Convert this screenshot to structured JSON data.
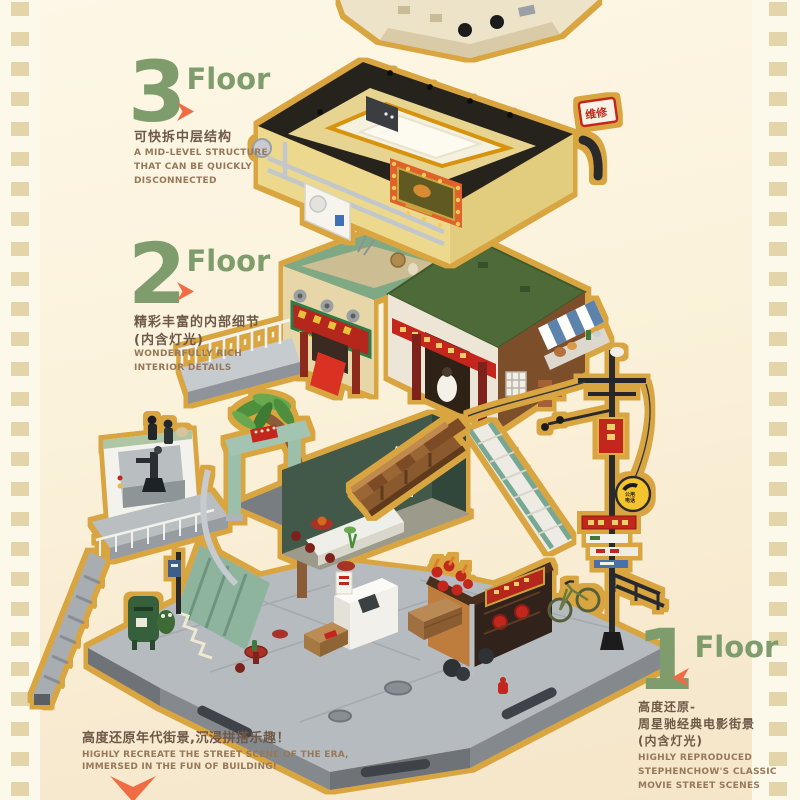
{
  "poster": {
    "floors": [
      {
        "number": "3",
        "suffix": "Floor",
        "arrow": "right",
        "zh_line1": "可快拆中层结构",
        "zh_line2": "",
        "zh_line3": "",
        "en_line1": "A MID-LEVEL STRUCTURE",
        "en_line2": "THAT CAN BE QUICKLY",
        "en_line3": "DISCONNECTED"
      },
      {
        "number": "2",
        "suffix": "Floor",
        "arrow": "right",
        "zh_line1": "精彩丰富的内部细节",
        "zh_line2": "(内含灯光)",
        "zh_line3": "",
        "en_line1": "WONDERFULLY RICH",
        "en_line2": "INTERIOR DETAILS",
        "en_line3": ""
      },
      {
        "number": "1",
        "suffix": "Floor",
        "arrow": "left",
        "zh_line1": "高度还原-",
        "zh_line2": "周星驰经典电影街景",
        "zh_line3": "(内含灯光)",
        "en_line1": "HIGHLY REPRODUCED",
        "en_line2": "STEPHENCHOW'S CLASSIC",
        "en_line3": "MOVIE STREET SCENES"
      }
    ],
    "footer": {
      "zh": "高度还原年代街景,沉浸拼搭乐趣！",
      "en_line1": "HIGHLY RECREATE THE STREET SCENE OF THE ERA,",
      "en_line2": "IMMERSED IN THE FUN OF BUILDING!"
    },
    "model_signs": {
      "repair": "维修",
      "seafood": "TAI PAK SEA FOOD",
      "phone_line1": "公用",
      "phone_line2": "电话"
    },
    "colors": {
      "green": "#7E9C6C",
      "orange": "#EF6C44",
      "zh_text": "#6E5949",
      "en_text": "#97785A",
      "film_square": "#E4D4AA",
      "film_bg": "#FDF9EA",
      "gold_outline": "#D9A53F"
    }
  }
}
